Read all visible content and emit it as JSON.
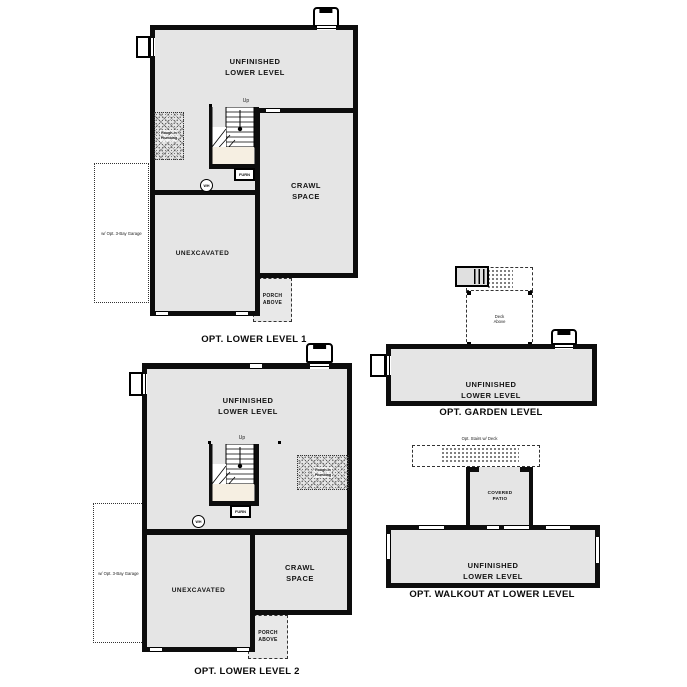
{
  "colors": {
    "background": "#ffffff",
    "floor_fill": "#e5e5e5",
    "wall": "#0d0d0d",
    "stair_landing": "#f6efe2"
  },
  "plans": {
    "lower1": {
      "caption": "OPT. LOWER LEVEL 1",
      "labels": {
        "unfinished": "UNFINISHED\nLOWER LEVEL",
        "crawl": "CRAWL\nSPACE",
        "unexcavated": "UNEXCAVATED",
        "porch": "PORCH\nABOVE",
        "garage_option": "w/ Opt. 3-Bay Garage",
        "rough_in": "Rough-In\nPlumbing",
        "furnace": "FURN",
        "water_heater": "WH",
        "up": "Up"
      }
    },
    "lower2": {
      "caption": "OPT. LOWER LEVEL 2",
      "labels": {
        "unfinished": "UNFINISHED\nLOWER LEVEL",
        "crawl": "CRAWL\nSPACE",
        "unexcavated": "UNEXCAVATED",
        "porch": "PORCH\nABOVE",
        "garage_option": "w/ Opt. 3-Bay Garage",
        "rough_in": "Rough-In\nPlumbing",
        "furnace": "FURN",
        "water_heater": "WH",
        "up": "Up"
      }
    },
    "garden": {
      "caption": "OPT. GARDEN LEVEL",
      "labels": {
        "unfinished": "UNFINISHED\nLOWER LEVEL",
        "deck": "Deck\nAbove"
      }
    },
    "walkout": {
      "caption": "OPT. WALKOUT AT LOWER LEVEL",
      "labels": {
        "unfinished": "UNFINISHED\nLOWER LEVEL",
        "patio": "COVERED\nPATIO",
        "stairs_option": "Opt. Stairs w/ Deck"
      }
    }
  }
}
